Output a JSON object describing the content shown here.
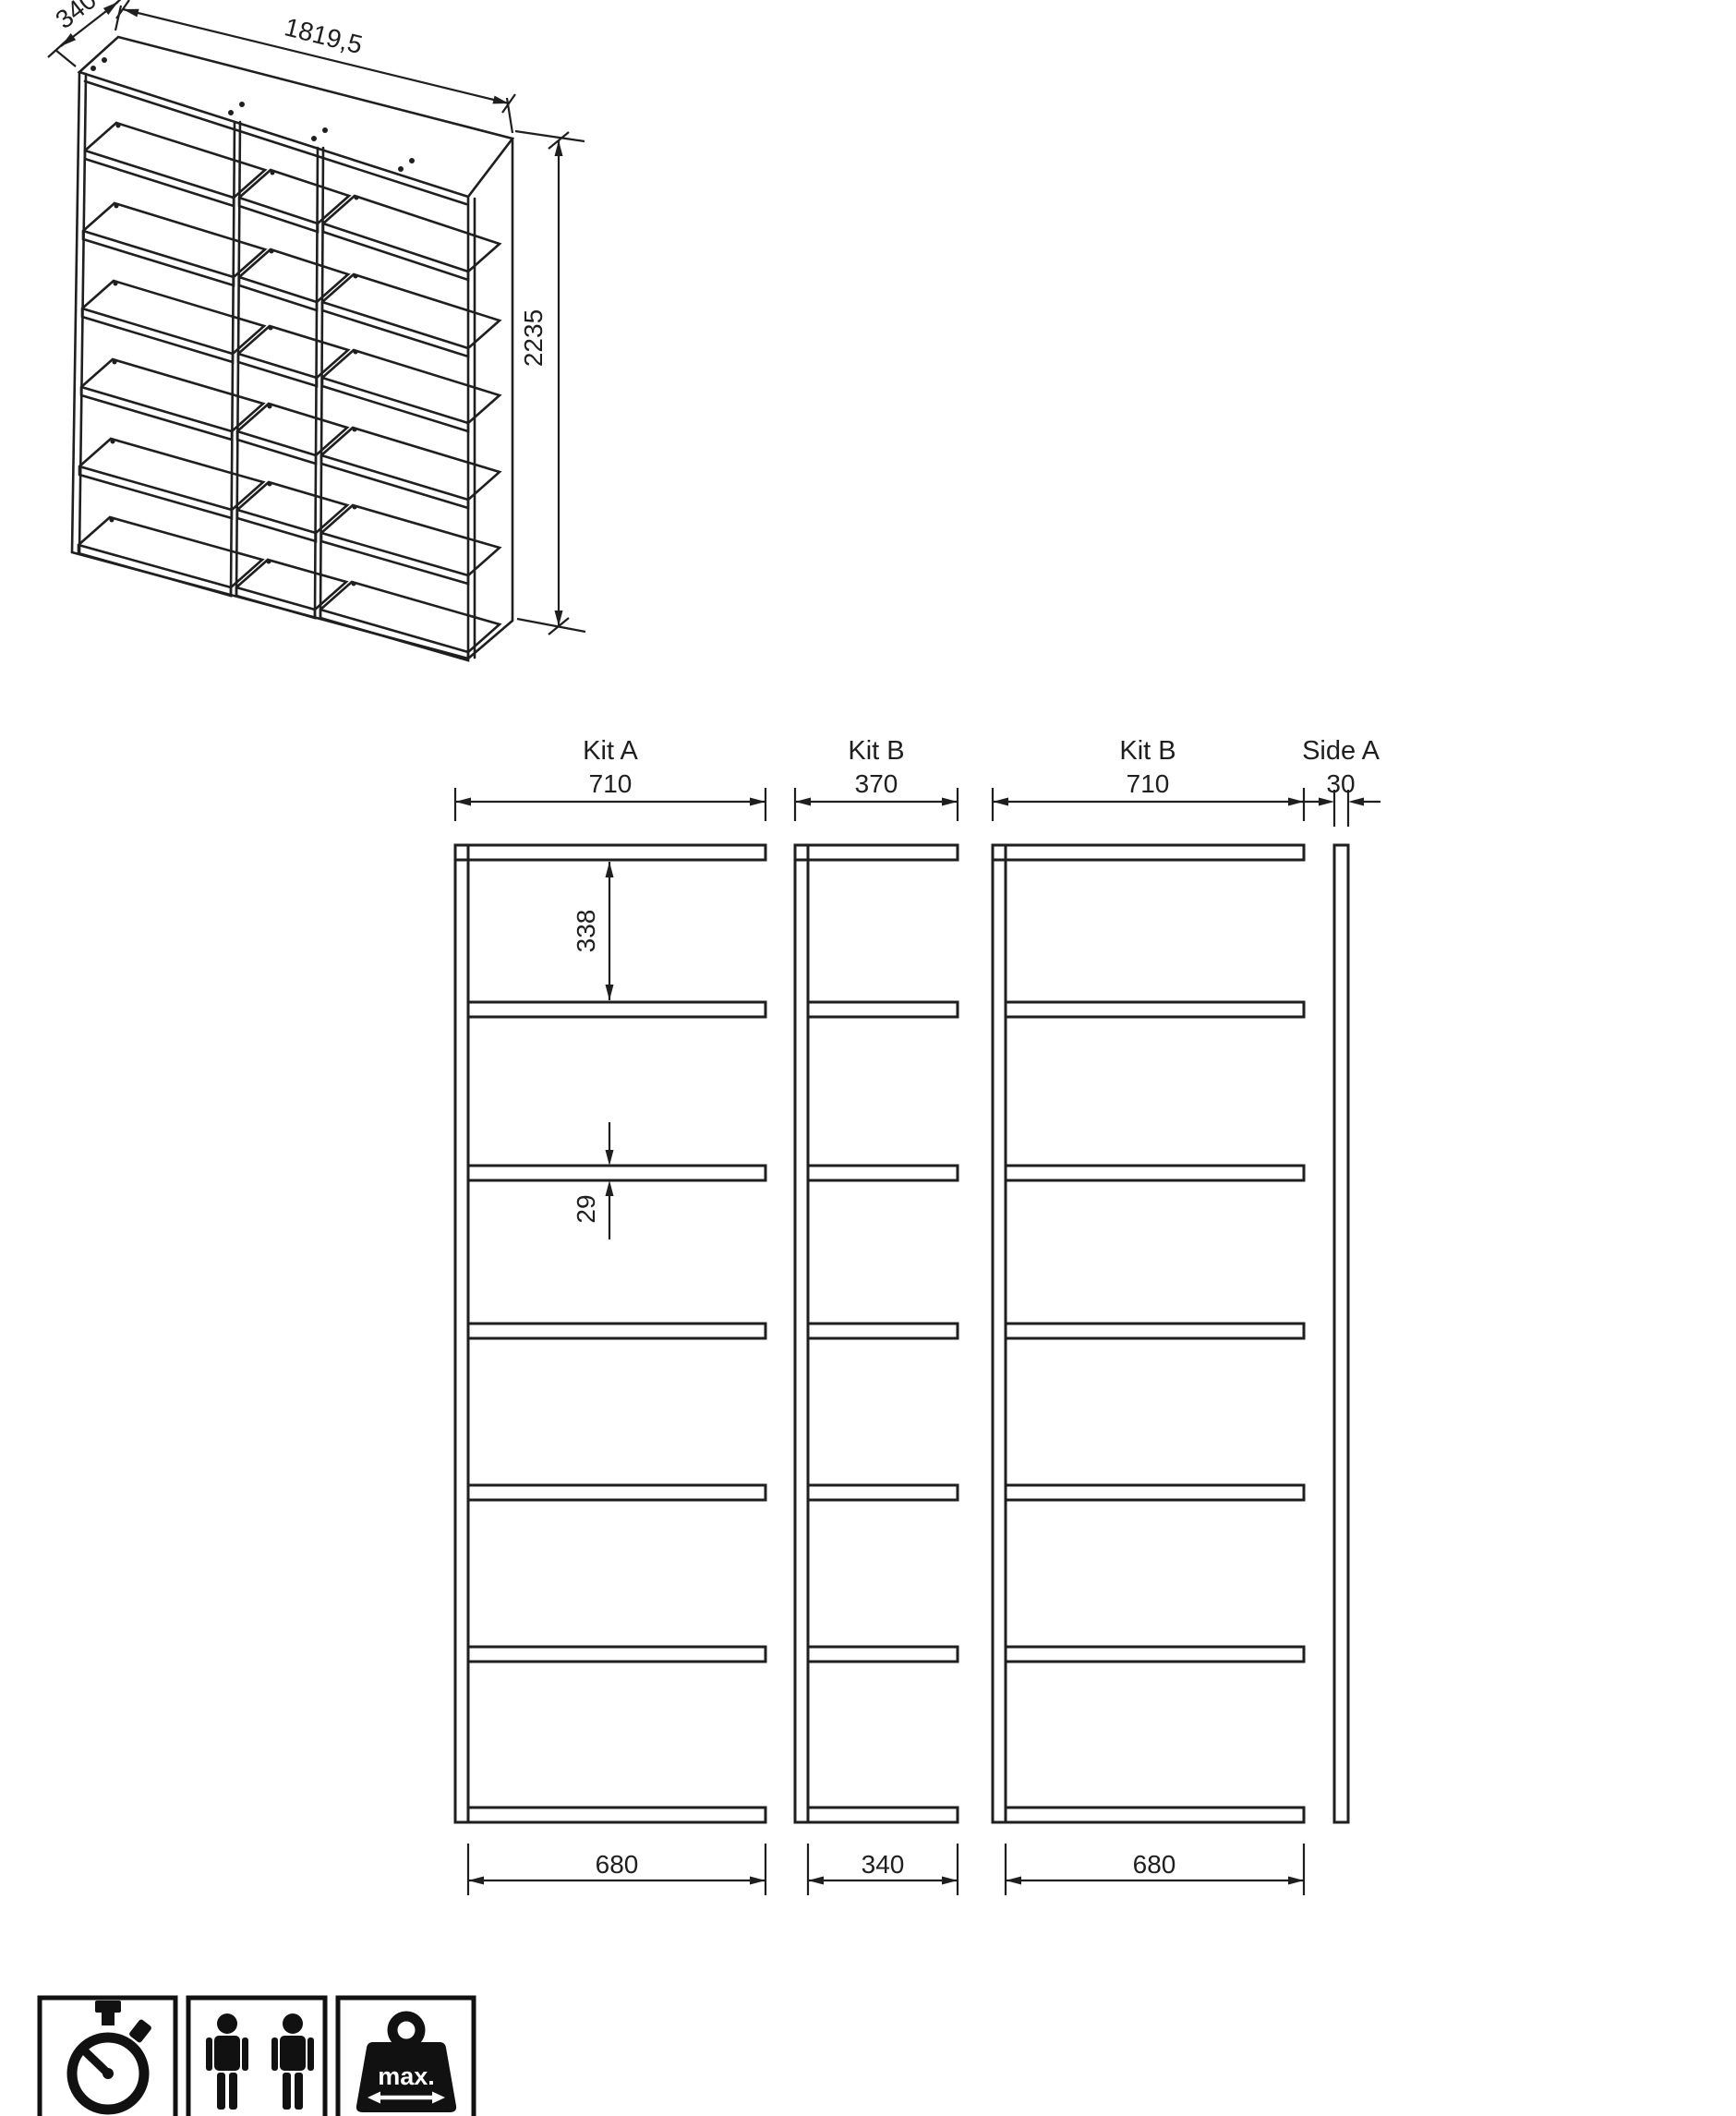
{
  "page": {
    "background": "#ffffff",
    "line_color": "#1f1f1f"
  },
  "isometric_view": {
    "depth_dim": "340",
    "width_dim": "1819,5",
    "height_dim": "2235"
  },
  "front_views": {
    "sections": [
      {
        "label": "Kit A",
        "top_dim": "710",
        "bottom_dim": "680"
      },
      {
        "label": "Kit B",
        "top_dim": "370",
        "bottom_dim": "340"
      },
      {
        "label": "Kit B",
        "top_dim": "710",
        "bottom_dim": "680"
      },
      {
        "label": "Side A",
        "top_dim": "30"
      }
    ],
    "first_gap_dim": "338",
    "shelf_thickness_dim": "29"
  },
  "footer": {
    "icons": [
      {
        "name": "stopwatch-icon"
      },
      {
        "name": "two-persons-icon"
      },
      {
        "name": "max-weight-icon",
        "label": "max."
      }
    ]
  }
}
